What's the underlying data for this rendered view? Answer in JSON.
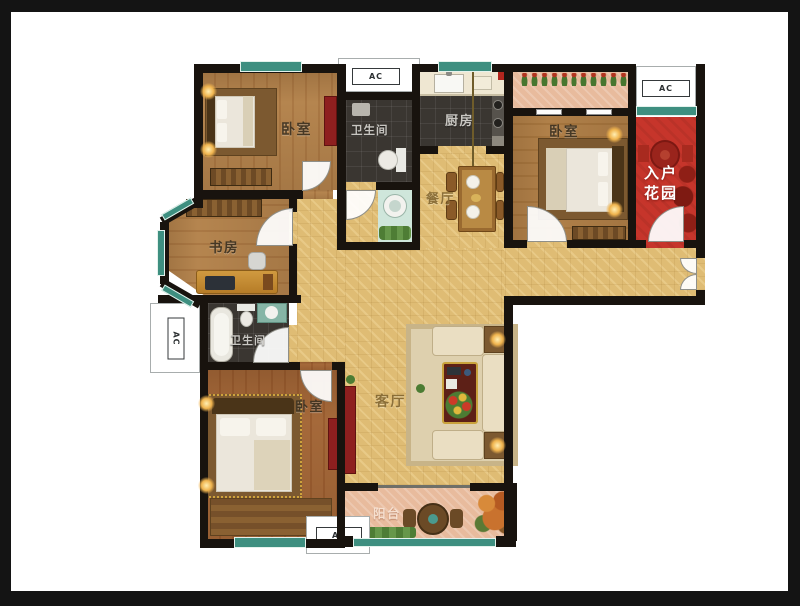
{
  "floorplan": {
    "rooms": [
      {
        "id": "bedroom-top-left",
        "label": "卧室"
      },
      {
        "id": "bathroom-top",
        "label": "卫生间"
      },
      {
        "id": "kitchen",
        "label": "厨房"
      },
      {
        "id": "dining-room",
        "label": "餐厅"
      },
      {
        "id": "bedroom-top-right",
        "label": "卧室"
      },
      {
        "id": "entry-garden",
        "label": "入户花园"
      },
      {
        "id": "study",
        "label": "书房"
      },
      {
        "id": "bathroom-left",
        "label": "卫生间"
      },
      {
        "id": "bedroom-bottom-left",
        "label": "卧室"
      },
      {
        "id": "living-room",
        "label": "客厅"
      },
      {
        "id": "balcony",
        "label": "阳台"
      }
    ],
    "ac_label": "AC",
    "colors": {
      "wall": "#18130e",
      "window_glass": "#3e8f80",
      "hall_floor": "#dfbc74",
      "wood_floor": "#b5854f",
      "tile_floor": "#3a3631",
      "entry_garden_floor": "#c6352b",
      "balcony_floor": "#e8bb9d",
      "cabinet_red": "#8e1f1f",
      "lamp_glow": "#f0b44e"
    }
  }
}
